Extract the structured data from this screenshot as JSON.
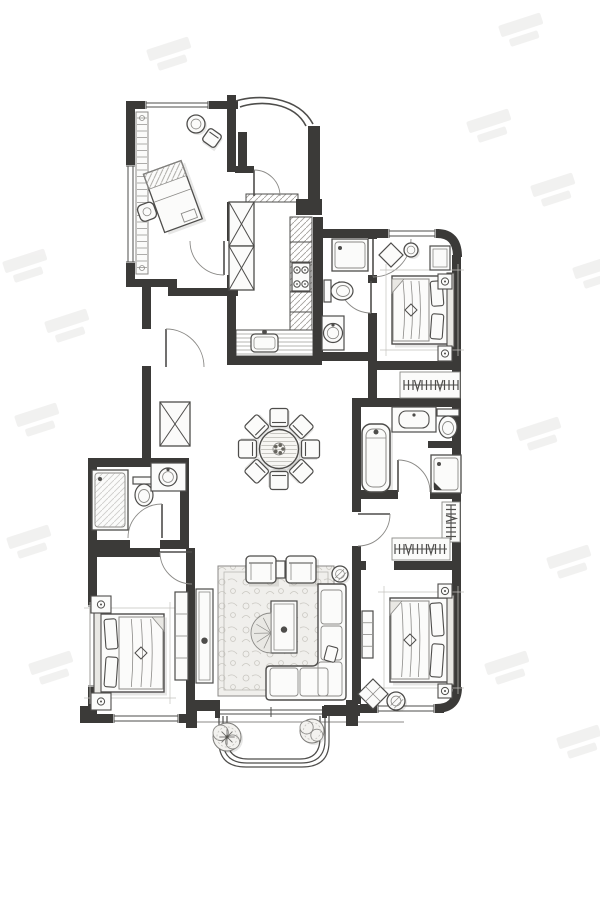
{
  "meta": {
    "title": "Hand-drawn apartment floor plan with study, three bedrooms, kitchen, three baths, round dining table and balcony",
    "canvas": {
      "w": 600,
      "h": 900
    }
  },
  "palette": {
    "paper": "#ffffff",
    "wall": "#3b3a38",
    "ink": "#4e4d4b",
    "mid": "#8b8a87",
    "light": "#c3c2be",
    "hatch": "#a3a19d",
    "shade": "rgba(70,68,64,0.13)",
    "fill": "#fbfbfa",
    "soft": "#e9e8e4",
    "rug": "#f0efec",
    "wm": "#e7e6e5"
  },
  "watermarks": {
    "rotation": -18,
    "positions": [
      [
        2,
        262
      ],
      [
        44,
        322
      ],
      [
        14,
        416
      ],
      [
        6,
        538
      ],
      [
        28,
        664
      ],
      [
        146,
        50
      ],
      [
        498,
        26
      ],
      [
        466,
        122
      ],
      [
        530,
        186
      ],
      [
        572,
        268
      ],
      [
        516,
        430
      ],
      [
        546,
        558
      ],
      [
        484,
        664
      ],
      [
        556,
        738
      ]
    ]
  },
  "plan": {
    "walls": [
      [
        126,
        101,
        9,
        65
      ],
      [
        126,
        262,
        9,
        25
      ],
      [
        126,
        101,
        22,
        8
      ],
      [
        208,
        101,
        30,
        8
      ],
      [
        227,
        95,
        9,
        77
      ],
      [
        227,
        202,
        9,
        39
      ],
      [
        227,
        275,
        9,
        13
      ],
      [
        126,
        279,
        48,
        8
      ],
      [
        168,
        279,
        9,
        17
      ],
      [
        168,
        288,
        70,
        8
      ],
      [
        238,
        132,
        9,
        36
      ],
      [
        235,
        166,
        19,
        7
      ],
      [
        308,
        126,
        12,
        76
      ],
      [
        296,
        199,
        26,
        16
      ],
      [
        313,
        217,
        10,
        144
      ],
      [
        227,
        288,
        9,
        77
      ],
      [
        227,
        356,
        95,
        9
      ],
      [
        313,
        229,
        64,
        9
      ],
      [
        368,
        229,
        9,
        10
      ],
      [
        368,
        275,
        9,
        8
      ],
      [
        368,
        313,
        9,
        48
      ],
      [
        313,
        352,
        64,
        9
      ],
      [
        377,
        229,
        62,
        9
      ],
      [
        452,
        255,
        9,
        112
      ],
      [
        368,
        361,
        93,
        9
      ],
      [
        368,
        370,
        9,
        37
      ],
      [
        452,
        367,
        9,
        40
      ],
      [
        352,
        398,
        109,
        9
      ],
      [
        352,
        403,
        9,
        96
      ],
      [
        452,
        407,
        9,
        96
      ],
      [
        428,
        441,
        33,
        7
      ],
      [
        352,
        490,
        46,
        9
      ],
      [
        430,
        490,
        31,
        9
      ],
      [
        352,
        499,
        9,
        13
      ],
      [
        352,
        546,
        9,
        24
      ],
      [
        452,
        499,
        9,
        190
      ],
      [
        352,
        561,
        14,
        9
      ],
      [
        394,
        561,
        67,
        9
      ],
      [
        352,
        570,
        9,
        134
      ],
      [
        360,
        704,
        18,
        9
      ],
      [
        434,
        704,
        10,
        9
      ],
      [
        186,
        548,
        9,
        175
      ],
      [
        186,
        700,
        34,
        11
      ],
      [
        186,
        700,
        11,
        28
      ],
      [
        324,
        705,
        36,
        11
      ],
      [
        346,
        700,
        12,
        26
      ],
      [
        88,
        458,
        9,
        148
      ],
      [
        88,
        686,
        9,
        37
      ],
      [
        88,
        458,
        100,
        9
      ],
      [
        180,
        458,
        9,
        90
      ],
      [
        88,
        540,
        42,
        9
      ],
      [
        160,
        540,
        28,
        9
      ],
      [
        88,
        548,
        72,
        9
      ],
      [
        88,
        714,
        26,
        9
      ],
      [
        178,
        714,
        17,
        9
      ],
      [
        80,
        706,
        14,
        17
      ],
      [
        142,
        287,
        9,
        42
      ],
      [
        142,
        366,
        9,
        92
      ]
    ],
    "wall_paths": [
      {
        "d": "M437,233.5 Q457.5,233.5 457.5,257",
        "w": 9,
        "name": "rounded-corner-top-right"
      },
      {
        "d": "M457.5,687 Q457.5,708.5 436,708.5",
        "w": 9,
        "name": "rounded-corner-bottom-right"
      }
    ],
    "canopy": [
      {
        "d": "M236,101 C258,94 298,96 313,124",
        "w": 1.6
      },
      {
        "d": "M240,107 C260,100 294,102 306,126",
        "w": 1.6
      }
    ],
    "balcony_rails": [
      "M219,716 V742 Q219,767 246,767 H302 Q329,767 329,742 V716",
      "M223,716 V740 Q223,763 247,763 H301 Q325,763 325,740 V716",
      "M227,716 V738 Q227,759 248,759 H300 Q320,759 320,738 V716"
    ],
    "site_line": "M96,722 H404",
    "slider": {
      "x1": 218,
      "x2": 324,
      "y1": 710,
      "y2": 714,
      "tick": 271
    },
    "windows": [
      {
        "x": 146,
        "y": 101,
        "len": 62,
        "dir": "h",
        "t": 8,
        "name": "study-window"
      },
      {
        "x": 126,
        "y": 166,
        "len": 96,
        "dir": "v",
        "t": 9,
        "name": "study-side-window"
      },
      {
        "x": 389,
        "y": 229,
        "len": 46,
        "dir": "h",
        "t": 9,
        "name": "bedroom2-window"
      },
      {
        "x": 378,
        "y": 704,
        "len": 56,
        "dir": "h",
        "t": 9,
        "name": "master-bedroom-window"
      },
      {
        "x": 114,
        "y": 714,
        "len": 64,
        "dir": "h",
        "t": 9,
        "name": "bedroom3-window"
      },
      {
        "x": 88,
        "y": 606,
        "len": 80,
        "dir": "v",
        "t": 9,
        "name": "bedroom3-side-window"
      }
    ],
    "doors": [
      {
        "leaf": [
          224,
          241,
          224,
          275
        ],
        "arc": "M224,275 A34 34 0 0 1 190,241",
        "name": "study-door"
      },
      {
        "leaf": [
          254,
          170,
          254,
          196
        ],
        "arc": "M254,170 A26 26 0 0 1 280,196",
        "name": "kitchen-door"
      },
      {
        "leaf": [
          373,
          239,
          373,
          277
        ],
        "arc": "M373,277 A38 38 0 0 0 411,239",
        "name": "bedroom2-door"
      },
      {
        "leaf": [
          371,
          281,
          371,
          313
        ],
        "arc": "M371,313 A32 32 0 0 1 339,281",
        "name": "small-bath-door"
      },
      {
        "leaf": [
          166,
          329,
          166,
          367
        ],
        "arc": "M166,329 A38 38 0 0 1 204,367",
        "name": "hall-door"
      },
      {
        "leaf": [
          162,
          504,
          162,
          538
        ],
        "arc": "M162,504 A34 34 0 0 0 128,538",
        "name": "bath2-door"
      },
      {
        "leaf": [
          160,
          552,
          192,
          552
        ],
        "arc": "M160,552 A32 32 0 0 0 192,584",
        "name": "bedroom3-door"
      },
      {
        "leaf": [
          398,
          460,
          398,
          492
        ],
        "arc": "M398,460 A32 32 0 0 1 430,492",
        "name": "master-bath-door"
      },
      {
        "leaf": [
          358,
          514,
          390,
          514
        ],
        "arc": "M390,514 A32 32 0 0 1 358,546",
        "name": "closet-door"
      }
    ],
    "furniture": [
      {
        "t": "shelf",
        "x": 136,
        "y": 112,
        "w": 12,
        "h": 162,
        "name": "study-bookshelf"
      },
      {
        "t": "round",
        "cx": 196,
        "cy": 124,
        "r": 9,
        "name": "study-side-table"
      },
      {
        "t": "chaird",
        "cx": 212,
        "cy": 138,
        "s": 15,
        "rot": 35,
        "name": "study-lounge-chair"
      },
      {
        "t": "deskg",
        "name": "study-desk"
      },
      {
        "t": "hatchrect",
        "x": 290,
        "y": 217,
        "w": 22,
        "h": 113,
        "dir": "d",
        "divs": [
          242,
          262,
          292,
          312
        ],
        "name": "kitchen-counter-right"
      },
      {
        "t": "stove",
        "x": 292,
        "y": 263,
        "w": 18,
        "h": 28,
        "name": "kitchen-stove"
      },
      {
        "t": "hatchrect",
        "x": 236,
        "y": 330,
        "w": 77,
        "h": 26,
        "dir": "h",
        "name": "kitchen-counter-bottom"
      },
      {
        "t": "sinkk",
        "x": 251,
        "y": 334,
        "w": 27,
        "h": 18,
        "name": "kitchen-sink"
      },
      {
        "t": "xbox",
        "x": 229,
        "y": 202,
        "w": 25,
        "h": 44,
        "name": "hall-cabinet"
      },
      {
        "t": "xbox",
        "x": 229,
        "y": 246,
        "w": 25,
        "h": 44,
        "name": "hall-cabinet"
      },
      {
        "t": "hatchrect",
        "x": 246,
        "y": 194,
        "w": 52,
        "h": 8,
        "dir": "d",
        "name": "entry-threshold"
      },
      {
        "t": "shower",
        "x": 332,
        "y": 239,
        "w": 36,
        "h": 32,
        "name": "small-bath-shower"
      },
      {
        "t": "toilet",
        "x": 324,
        "y": 280,
        "dir": "right",
        "name": "small-bath-toilet"
      },
      {
        "t": "cab",
        "x": 322,
        "y": 316,
        "w": 22,
        "h": 34,
        "name": "small-bath-vanity"
      },
      {
        "t": "sinkr",
        "cx": 333,
        "cy": 333,
        "r": 9.5,
        "name": "small-bath-basin"
      },
      {
        "t": "bed",
        "x": 392,
        "y": 276,
        "w": 60,
        "h": 68,
        "head": "right",
        "name": "bedroom2-bed"
      },
      {
        "t": "cab",
        "x": 430,
        "y": 246,
        "w": 20,
        "h": 24,
        "inner": true,
        "name": "bedroom2-dresser"
      },
      {
        "t": "nstand",
        "x": 438,
        "y": 274,
        "w": 14,
        "h": 15,
        "name": "bedroom2-nightstand"
      },
      {
        "t": "nstand",
        "x": 438,
        "y": 346,
        "w": 14,
        "h": 15,
        "name": "bedroom2-nightstand"
      },
      {
        "t": "diamond",
        "cx": 391,
        "cy": 255,
        "s": 12,
        "name": "bedroom2-floor-cushion"
      },
      {
        "t": "round",
        "cx": 411,
        "cy": 250,
        "r": 7,
        "name": "bedroom2-floor-cushion"
      },
      {
        "t": "hanger",
        "frame": [
          400,
          372,
          60,
          26
        ],
        "rail": [
          404,
          385,
          458,
          385
        ],
        "name": "bedroom2-closet-rail"
      },
      {
        "t": "tub",
        "x": 362,
        "y": 424,
        "w": 28,
        "h": 68,
        "name": "master-bath-tub"
      },
      {
        "t": "cab",
        "x": 392,
        "y": 407,
        "w": 44,
        "h": 25,
        "name": "master-bath-vanity"
      },
      {
        "t": "sinko",
        "x": 399,
        "y": 411,
        "w": 30,
        "h": 17,
        "name": "master-bath-sink"
      },
      {
        "t": "toilet",
        "x": 437,
        "y": 409,
        "dir": "down",
        "name": "master-bath-toilet"
      },
      {
        "t": "shower",
        "x": 431,
        "y": 455,
        "w": 30,
        "h": 38,
        "drain": true,
        "name": "master-bath-shower"
      },
      {
        "t": "hanger",
        "frame": [
          442,
          502,
          18,
          40
        ],
        "rail": [
          451,
          505,
          451,
          540
        ],
        "name": "closet-rail"
      },
      {
        "t": "hanger",
        "frame": [
          392,
          538,
          58,
          22
        ],
        "rail": [
          395,
          549,
          447,
          549
        ],
        "name": "closet-rail"
      },
      {
        "t": "bed",
        "x": 390,
        "y": 598,
        "w": 62,
        "h": 84,
        "head": "right",
        "name": "master-bed"
      },
      {
        "t": "nstand",
        "x": 438,
        "y": 584,
        "w": 14,
        "h": 14,
        "name": "master-nightstand"
      },
      {
        "t": "nstand",
        "x": 438,
        "y": 684,
        "w": 14,
        "h": 14,
        "name": "master-nightstand"
      },
      {
        "t": "cab",
        "x": 362,
        "y": 611,
        "w": 11,
        "h": 47,
        "lines": "h",
        "name": "master-bench"
      },
      {
        "t": "diamond",
        "cx": 373,
        "cy": 694,
        "s": 15,
        "stitch": true,
        "name": "master-ottoman"
      },
      {
        "t": "round",
        "cx": 396,
        "cy": 701,
        "r": 9,
        "hatch": true,
        "name": "master-pouf"
      },
      {
        "t": "rug",
        "x": 218,
        "y": 566,
        "w": 116,
        "h": 130,
        "name": "living-room-rug"
      },
      {
        "t": "armchair",
        "x": 246,
        "y": 556,
        "w": 30,
        "h": 27,
        "name": "living-armchair"
      },
      {
        "t": "armchair",
        "x": 286,
        "y": 556,
        "w": 30,
        "h": 27,
        "name": "living-armchair"
      },
      {
        "t": "cab",
        "x": 276,
        "y": 561,
        "w": 9,
        "h": 17,
        "name": "living-side-table"
      },
      {
        "t": "sofaL",
        "outer": "M318,584 H342 Q346,584 346,588 V696 Q346,700 342,700 H270 Q266,700 266,696 V670 Q266,666 270,666 H312 Q318,666 318,660 Z",
        "cushions": [
          [
            321,
            590,
            21,
            34
          ],
          [
            321,
            626,
            21,
            34
          ],
          [
            318,
            662,
            24,
            34
          ],
          [
            270,
            668,
            28,
            28
          ],
          [
            300,
            668,
            28,
            28
          ]
        ],
        "pillow": [
          331,
          654,
          11,
          15
        ],
        "name": "living-sofa"
      },
      {
        "t": "cab",
        "x": 271,
        "y": 601,
        "w": 26,
        "h": 52,
        "inner": true,
        "dot": true,
        "name": "living-coffee-table"
      },
      {
        "t": "halfround",
        "cx": 271,
        "cy": 633,
        "r": 20,
        "name": "living-fan-seat"
      },
      {
        "t": "round",
        "cx": 340,
        "cy": 574,
        "r": 8,
        "hatch": true,
        "name": "sofa-side-table"
      },
      {
        "t": "cab",
        "x": 196,
        "y": 589,
        "w": 17,
        "h": 94,
        "inner": true,
        "dot": true,
        "name": "tv-console"
      },
      {
        "t": "bed",
        "x": 96,
        "y": 614,
        "w": 68,
        "h": 78,
        "head": "left",
        "name": "bedroom3-bed"
      },
      {
        "t": "nstand",
        "x": 91,
        "y": 596,
        "w": 20,
        "h": 17,
        "name": "bedroom3-nightstand"
      },
      {
        "t": "nstand",
        "x": 91,
        "y": 693,
        "w": 20,
        "h": 17,
        "name": "bedroom3-nightstand"
      },
      {
        "t": "cab",
        "x": 175,
        "y": 592,
        "w": 13,
        "h": 88,
        "lines": "h",
        "name": "bedroom3-wardrobe"
      },
      {
        "t": "shower",
        "x": 92,
        "y": 470,
        "w": 36,
        "h": 60,
        "glass": true,
        "name": "bath2-shower"
      },
      {
        "t": "toilet",
        "x": 133,
        "y": 477,
        "dir": "down",
        "name": "bath2-toilet"
      },
      {
        "t": "cab",
        "x": 151,
        "y": 463,
        "w": 35,
        "h": 28,
        "name": "bath2-vanity"
      },
      {
        "t": "sinkr",
        "cx": 168,
        "cy": 477,
        "r": 9,
        "name": "bath2-basin"
      },
      {
        "t": "xbox",
        "x": 160,
        "y": 402,
        "w": 30,
        "h": 44,
        "name": "utility-shaft"
      },
      {
        "t": "plant",
        "cx": 227,
        "cy": 737,
        "r": 14,
        "pin": true,
        "name": "balcony-plant"
      },
      {
        "t": "plant",
        "cx": 312,
        "cy": 731,
        "r": 12,
        "name": "balcony-plant"
      },
      {
        "t": "dining",
        "cx": 279,
        "cy": 449,
        "r": 19.5,
        "cr": 31.5,
        "cs": 18,
        "chairs": 8,
        "name": "dining-table-set"
      }
    ]
  }
}
